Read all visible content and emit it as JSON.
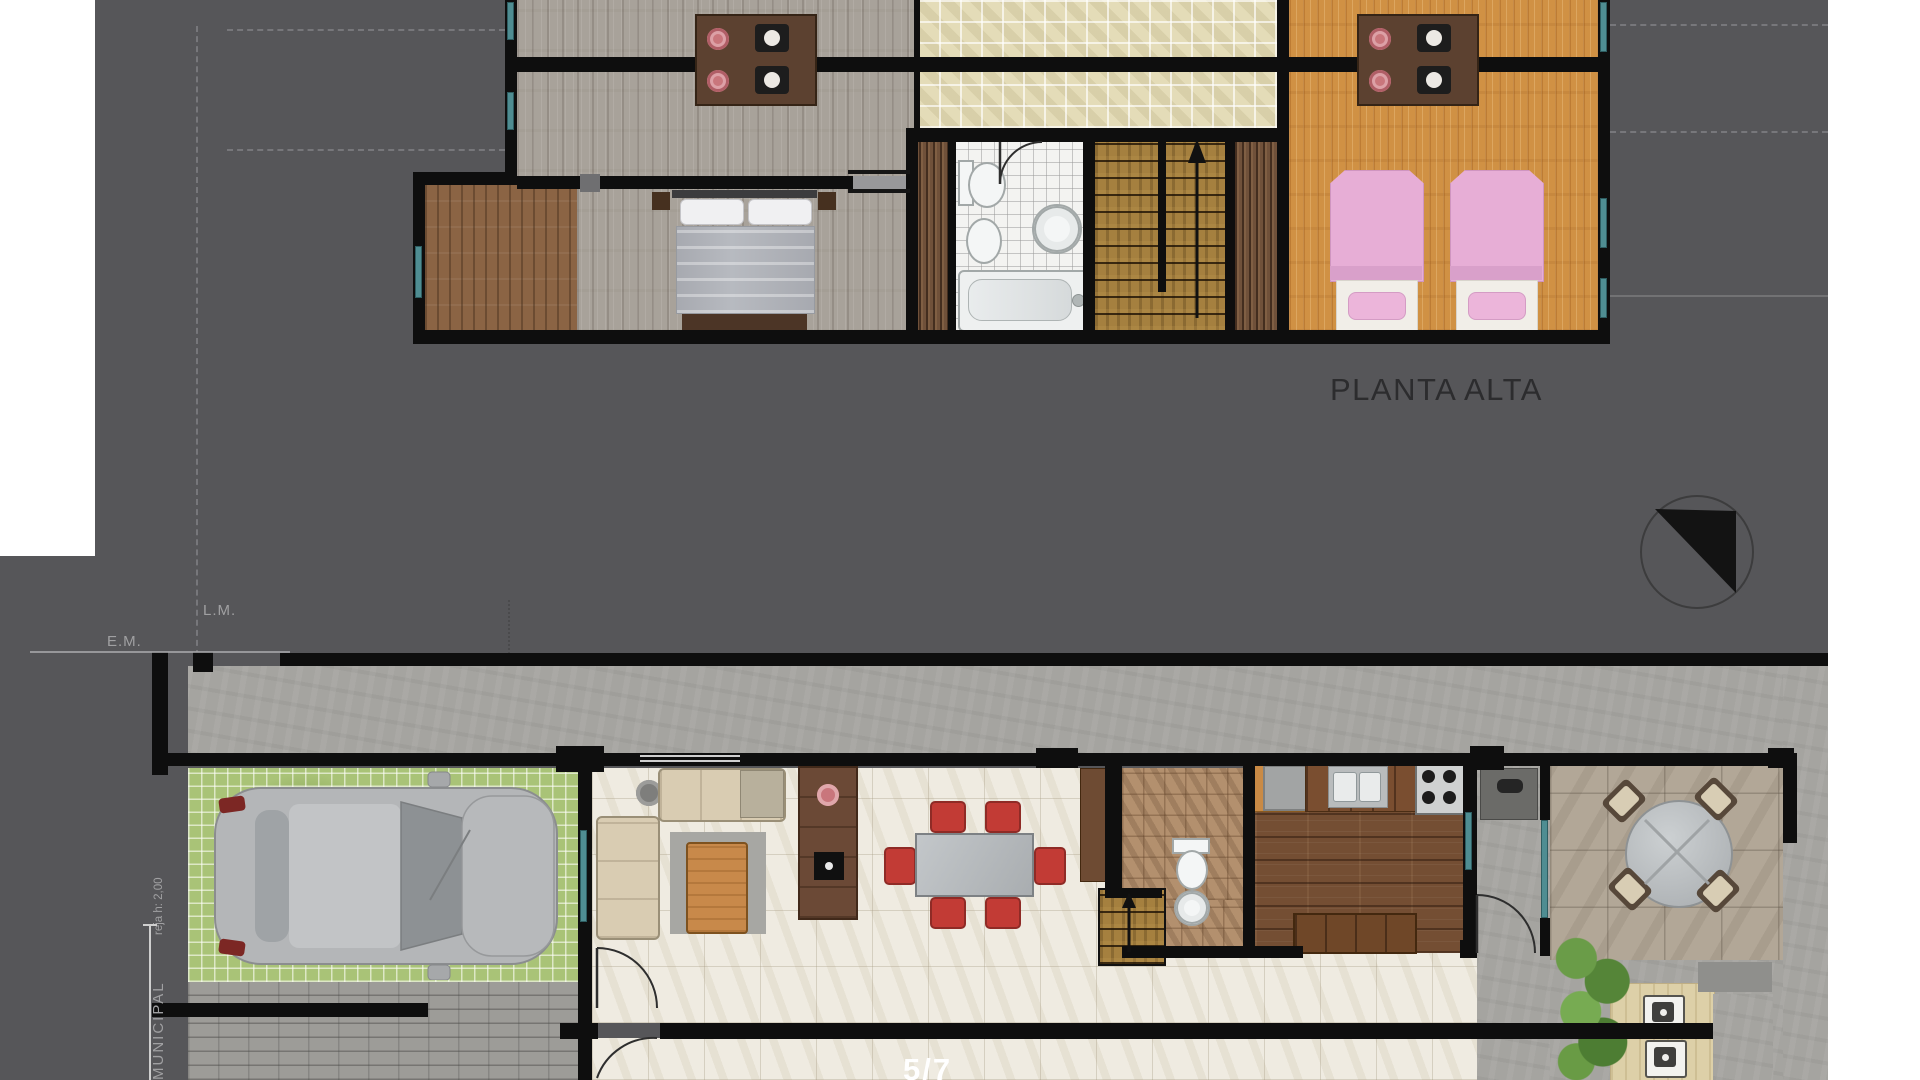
{
  "upper_plan": {
    "title": "PLANTA ALTA"
  },
  "annotations": {
    "property_line": "L.M.",
    "municipal_axis": "E.M.",
    "municipal": "MUNICIPAL",
    "fence_height_note": "reja h: 2,00"
  },
  "footer": {
    "page_indicator": "5/7"
  },
  "icons": {
    "north_arrow": "north-arrow-icon",
    "stairs_up_upper": "stairs-up-arrow-icon",
    "stairs_up_ground": "stairs-up-arrow-icon"
  },
  "colors": {
    "page_background": "#565659",
    "paper": "#ffffff",
    "wall": "#0e0e0e",
    "window_teal": "#4f8d92",
    "terrace_tile": "#e4dcb8",
    "gray_wood_floor": "#a8a29a",
    "orange_wood_floor": "#d09144",
    "cream_tile_floor": "#efebe1",
    "kitchen_wood_floor": "#744e33",
    "grass_pavers": "#a9c377",
    "concrete": "#a5a4a0",
    "bed_pink": "#e7aed6",
    "dining_chair_red": "#c23b35",
    "title_color": "#2c2c2e",
    "annotation_color": "#a0a0a2"
  }
}
